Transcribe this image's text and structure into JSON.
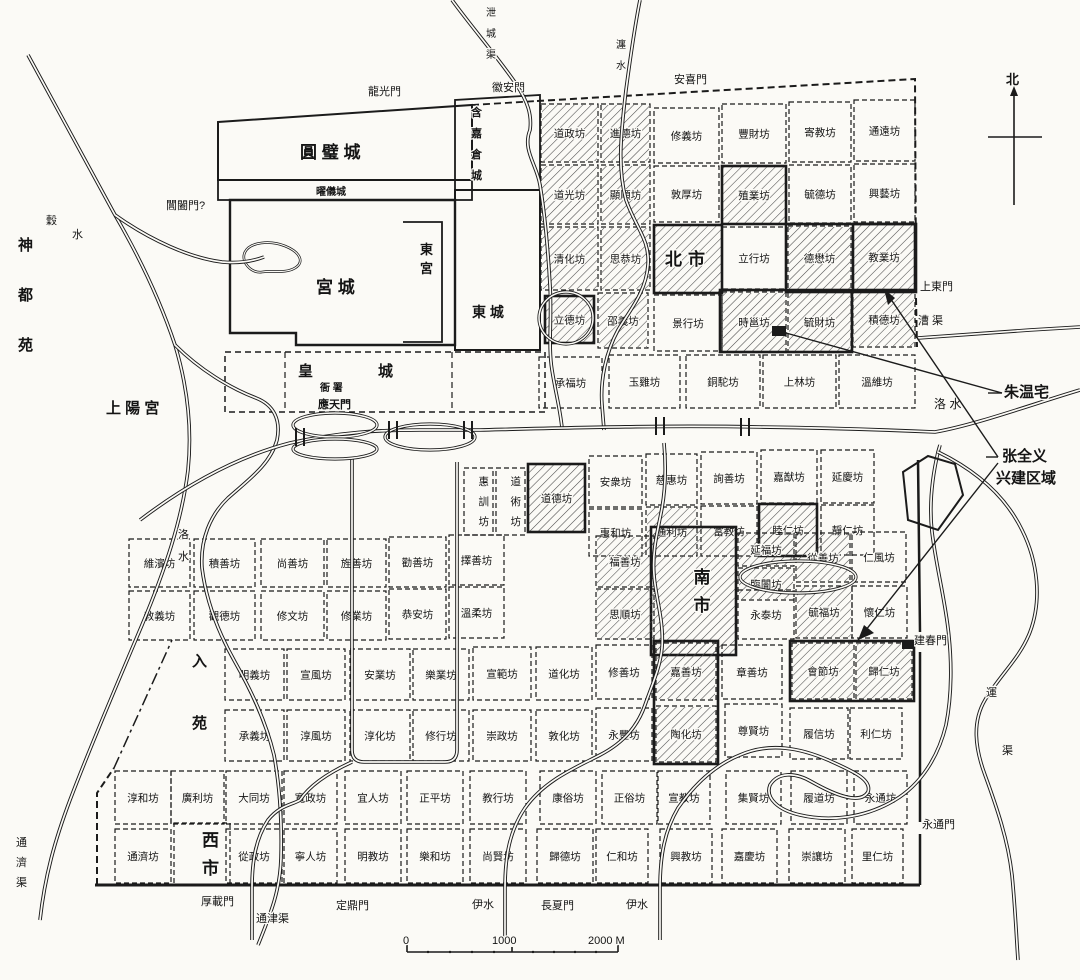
{
  "map": {
    "compass": {
      "label": "北"
    },
    "scale_bar": {
      "labels": [
        {
          "t": "0",
          "x": 403
        },
        {
          "t": "1000",
          "x": 492
        },
        {
          "t": "2000 M",
          "x": 588
        }
      ],
      "label_y": 944,
      "x1": 407,
      "x2": 618,
      "y": 952
    },
    "wards": [
      [
        "道政坊",
        541,
        104,
        57,
        58,
        "h"
      ],
      [
        "進德坊",
        601,
        104,
        49,
        58,
        "h"
      ],
      [
        "修義坊",
        654,
        108,
        65,
        55,
        ""
      ],
      [
        "豐財坊",
        722,
        104,
        64,
        59,
        ""
      ],
      [
        "寄教坊",
        789,
        102,
        62,
        60,
        ""
      ],
      [
        "通遠坊",
        854,
        100,
        61,
        61,
        ""
      ],
      [
        "道光坊",
        541,
        165,
        57,
        59,
        "h"
      ],
      [
        "顯順坊",
        601,
        165,
        49,
        59,
        "h"
      ],
      [
        "敦厚坊",
        654,
        166,
        65,
        56,
        ""
      ],
      [
        "殖業坊",
        722,
        166,
        64,
        58,
        "hb"
      ],
      [
        "毓德坊",
        789,
        165,
        62,
        58,
        ""
      ],
      [
        "興藝坊",
        854,
        164,
        61,
        58,
        ""
      ],
      [
        "清化坊",
        541,
        227,
        57,
        63,
        "h"
      ],
      [
        "思恭坊",
        601,
        227,
        49,
        63,
        "h"
      ],
      [
        "北市",
        654,
        225,
        68,
        68,
        "hbm"
      ],
      [
        "立行坊",
        722,
        227,
        64,
        62,
        ""
      ],
      [
        "德懋坊",
        788,
        226,
        63,
        64,
        "h"
      ],
      [
        "教業坊",
        853,
        224,
        62,
        66,
        "hb"
      ],
      [
        "立德坊",
        545,
        296,
        49,
        47,
        "hb"
      ],
      [
        "邵義坊",
        598,
        293,
        50,
        55,
        "h"
      ],
      [
        "景行坊",
        654,
        295,
        68,
        56,
        ""
      ],
      [
        "時邕坊",
        722,
        292,
        64,
        60,
        "h"
      ],
      [
        "毓財坊",
        788,
        292,
        63,
        60,
        "h"
      ],
      [
        "積德坊",
        853,
        292,
        62,
        55,
        "h"
      ],
      [
        "承福坊",
        539,
        357,
        63,
        51,
        ""
      ],
      [
        "玉雞坊",
        609,
        355,
        71,
        53,
        ""
      ],
      [
        "銅駝坊",
        686,
        355,
        74,
        53,
        ""
      ],
      [
        "上林坊",
        763,
        355,
        73,
        53,
        ""
      ],
      [
        "溫維坊",
        839,
        355,
        76,
        53,
        ""
      ],
      [
        "惠訓坊",
        464,
        468,
        29,
        67,
        "v"
      ],
      [
        "道術坊",
        496,
        468,
        29,
        67,
        "v"
      ],
      [
        "道德坊",
        528,
        464,
        57,
        68,
        "hb"
      ],
      [
        "安衆坊",
        589,
        456,
        53,
        51,
        ""
      ],
      [
        "慈惠坊",
        646,
        454,
        51,
        51,
        ""
      ],
      [
        "詢善坊",
        701,
        452,
        56,
        52,
        ""
      ],
      [
        "嘉猷坊",
        761,
        450,
        56,
        53,
        ""
      ],
      [
        "延慶坊",
        821,
        450,
        53,
        53,
        ""
      ],
      [
        "惠和坊",
        589,
        509,
        53,
        47,
        ""
      ],
      [
        "通利坊",
        646,
        507,
        51,
        49,
        "h"
      ],
      [
        "富教坊",
        701,
        506,
        56,
        50,
        ""
      ],
      [
        "睦仁坊",
        759,
        504,
        58,
        52,
        "hb"
      ],
      [
        "靜仁坊",
        821,
        505,
        53,
        50,
        ""
      ],
      [
        "維濱坊",
        129,
        539,
        61,
        48,
        ""
      ],
      [
        "積善坊",
        194,
        539,
        61,
        48,
        ""
      ],
      [
        "尚善坊",
        261,
        539,
        63,
        48,
        ""
      ],
      [
        "旌善坊",
        327,
        539,
        59,
        48,
        ""
      ],
      [
        "勸善坊",
        389,
        537,
        57,
        50,
        ""
      ],
      [
        "擇善坊",
        449,
        535,
        55,
        50,
        ""
      ],
      [
        "福善坊",
        596,
        536,
        58,
        51,
        "h"
      ],
      [
        "南市",
        651,
        527,
        85,
        128,
        "hbvm"
      ],
      [
        "延福坊",
        738,
        533,
        56,
        33,
        "h"
      ],
      [
        "臨闠坊",
        738,
        568,
        56,
        32,
        "h"
      ],
      [
        "從善坊",
        796,
        533,
        54,
        49,
        "h"
      ],
      [
        "仁風坊",
        852,
        532,
        54,
        50,
        ""
      ],
      [
        "教義坊",
        129,
        591,
        61,
        49,
        ""
      ],
      [
        "觀德坊",
        194,
        591,
        61,
        49,
        ""
      ],
      [
        "修文坊",
        261,
        591,
        63,
        49,
        ""
      ],
      [
        "修業坊",
        327,
        591,
        59,
        49,
        ""
      ],
      [
        "恭安坊",
        389,
        589,
        57,
        50,
        ""
      ],
      [
        "溫柔坊",
        449,
        587,
        55,
        51,
        ""
      ],
      [
        "思順坊",
        596,
        589,
        58,
        50,
        "h"
      ],
      [
        "永泰坊",
        738,
        590,
        56,
        49,
        ""
      ],
      [
        "毓福坊",
        796,
        586,
        56,
        52,
        "h"
      ],
      [
        "懷仁坊",
        852,
        586,
        55,
        52,
        ""
      ],
      [
        "明義坊",
        225,
        649,
        59,
        51,
        ""
      ],
      [
        "宣風坊",
        287,
        649,
        58,
        51,
        ""
      ],
      [
        "安業坊",
        350,
        649,
        60,
        51,
        ""
      ],
      [
        "樂業坊",
        413,
        649,
        56,
        51,
        ""
      ],
      [
        "宣範坊",
        473,
        647,
        58,
        53,
        ""
      ],
      [
        "道化坊",
        536,
        647,
        56,
        53,
        ""
      ],
      [
        "修善坊",
        596,
        645,
        56,
        54,
        ""
      ],
      [
        "嘉善坊",
        656,
        643,
        60,
        57,
        "h"
      ],
      [
        "章善坊",
        722,
        645,
        60,
        54,
        ""
      ],
      [
        "會節坊",
        792,
        643,
        62,
        56,
        "h"
      ],
      [
        "歸仁坊",
        856,
        643,
        56,
        56,
        "h"
      ],
      [
        "承義坊",
        225,
        710,
        59,
        51,
        ""
      ],
      [
        "淳風坊",
        287,
        710,
        58,
        51,
        ""
      ],
      [
        "淳化坊",
        350,
        710,
        60,
        51,
        ""
      ],
      [
        "修行坊",
        413,
        710,
        56,
        51,
        ""
      ],
      [
        "崇政坊",
        473,
        710,
        58,
        51,
        ""
      ],
      [
        "敦化坊",
        536,
        710,
        56,
        51,
        ""
      ],
      [
        "永豐坊",
        596,
        708,
        56,
        53,
        ""
      ],
      [
        "陶化坊",
        656,
        706,
        60,
        56,
        "h"
      ],
      [
        "尊賢坊",
        725,
        704,
        57,
        53,
        ""
      ],
      [
        "履信坊",
        790,
        708,
        58,
        51,
        ""
      ],
      [
        "利仁坊",
        850,
        708,
        52,
        51,
        ""
      ],
      [
        "淳和坊",
        115,
        771,
        56,
        53,
        ""
      ],
      [
        "廣利坊",
        171,
        771,
        53,
        53,
        ""
      ],
      [
        "大同坊",
        226,
        771,
        56,
        53,
        ""
      ],
      [
        "寬政坊",
        284,
        771,
        53,
        53,
        ""
      ],
      [
        "宜人坊",
        345,
        771,
        56,
        53,
        ""
      ],
      [
        "正平坊",
        407,
        771,
        56,
        53,
        ""
      ],
      [
        "教行坊",
        470,
        771,
        56,
        53,
        ""
      ],
      [
        "康俗坊",
        540,
        771,
        56,
        53,
        ""
      ],
      [
        "正俗坊",
        602,
        771,
        55,
        53,
        ""
      ],
      [
        "宣教坊",
        658,
        771,
        52,
        53,
        ""
      ],
      [
        "集賢坊",
        726,
        771,
        55,
        53,
        ""
      ],
      [
        "履道坊",
        791,
        771,
        56,
        53,
        ""
      ],
      [
        "永通坊",
        854,
        771,
        53,
        53,
        ""
      ],
      [
        "通濟坊",
        115,
        829,
        56,
        54,
        ""
      ],
      [
        "西市",
        174,
        823,
        56,
        62,
        "vm"
      ],
      [
        "從政坊",
        226,
        829,
        56,
        54,
        ""
      ],
      [
        "寧人坊",
        284,
        829,
        53,
        54,
        ""
      ],
      [
        "明教坊",
        345,
        829,
        56,
        54,
        ""
      ],
      [
        "樂和坊",
        407,
        829,
        56,
        54,
        ""
      ],
      [
        "尚賢坊",
        470,
        829,
        56,
        54,
        ""
      ],
      [
        "歸德坊",
        537,
        829,
        56,
        54,
        ""
      ],
      [
        "仁和坊",
        596,
        829,
        52,
        54,
        ""
      ],
      [
        "興教坊",
        660,
        829,
        52,
        54,
        ""
      ],
      [
        "嘉慶坊",
        722,
        829,
        55,
        54,
        ""
      ],
      [
        "崇讓坊",
        789,
        829,
        56,
        54,
        ""
      ],
      [
        "里仁坊",
        852,
        829,
        51,
        54,
        ""
      ]
    ],
    "bold_outlines": [
      [
        720,
        290,
        132,
        62
      ],
      [
        786,
        224,
        130,
        68
      ],
      [
        790,
        641,
        124,
        60
      ],
      [
        654,
        641,
        64,
        123
      ]
    ],
    "regions": [
      [
        "圓 璧 城",
        300,
        158,
        17,
        0,
        0
      ],
      [
        "曜儀城",
        316,
        195,
        10,
        0,
        0
      ],
      [
        "宮  城",
        316,
        293,
        17,
        0,
        0
      ],
      [
        "東宮",
        420,
        254,
        13,
        1,
        19
      ],
      [
        "東 城",
        472,
        317,
        14,
        0,
        0
      ],
      [
        "含嘉倉城",
        471,
        116,
        11,
        1,
        21
      ],
      [
        "皇",
        298,
        376,
        15,
        0,
        0
      ],
      [
        "城",
        378,
        376,
        15,
        0,
        0
      ],
      [
        "衙 署",
        320,
        391,
        10,
        0,
        0
      ],
      [
        "應天門",
        318,
        408,
        11,
        0,
        0
      ],
      [
        "神都苑",
        18,
        250,
        15,
        1,
        50
      ],
      [
        "上 陽 宮",
        106,
        413,
        15,
        0,
        0
      ],
      [
        "入苑",
        192,
        666,
        15,
        1,
        62
      ]
    ],
    "gates": [
      [
        "龍光門",
        368,
        95,
        11,
        0,
        0
      ],
      [
        "徽安門",
        492,
        91,
        11,
        0,
        0
      ],
      [
        "安喜門",
        674,
        83,
        11,
        0,
        0
      ],
      [
        "閶闔門?",
        166,
        209,
        11,
        0,
        0
      ],
      [
        "上東門",
        920,
        290,
        11,
        0,
        0
      ],
      [
        "建春門",
        914,
        644,
        11,
        0,
        0
      ],
      [
        "永通門",
        922,
        828,
        11,
        0,
        0
      ],
      [
        "厚載門",
        201,
        905,
        11,
        0,
        0
      ],
      [
        "定鼎門",
        336,
        909,
        11,
        0,
        0
      ],
      [
        "長夏門",
        541,
        909,
        11,
        0,
        0
      ]
    ],
    "waters": [
      [
        "泄城渠",
        486,
        16,
        10,
        1,
        21
      ],
      [
        "瀍水",
        616,
        48,
        10,
        1,
        21
      ],
      [
        "穀",
        46,
        224,
        11,
        0,
        0
      ],
      [
        "水",
        72,
        238,
        11,
        0,
        0
      ],
      [
        "洛水",
        178,
        538,
        11,
        1,
        22
      ],
      [
        "洛  水",
        934,
        408,
        12,
        0,
        0
      ],
      [
        "漕 渠",
        918,
        324,
        11,
        0,
        0
      ],
      [
        "運",
        986,
        696,
        11,
        0,
        0
      ],
      [
        "渠",
        1002,
        754,
        11,
        0,
        0
      ],
      [
        "通濟渠",
        16,
        846,
        11,
        1,
        20
      ],
      [
        "通津渠",
        256,
        922,
        11,
        0,
        0
      ],
      [
        "伊水",
        472,
        908,
        11,
        0,
        0
      ],
      [
        "伊水",
        626,
        908,
        11,
        0,
        0
      ]
    ],
    "annotations": {
      "labels": [
        [
          "朱温宅",
          1004,
          397,
          15
        ],
        [
          "张全义",
          1002,
          461,
          15
        ],
        [
          "兴建区域",
          996,
          483,
          15
        ]
      ],
      "lines": [
        [
          988,
          393,
          1002,
          393
        ],
        [
          1002,
          393,
          786,
          333
        ],
        [
          986,
          457,
          998,
          457
        ],
        [
          998,
          457,
          884,
          289
        ],
        [
          998,
          463,
          858,
          640
        ]
      ],
      "arrowheads": [
        "884,289 895,298 888,305",
        "858,640 864,625 874,633"
      ],
      "site_squares": [
        [
          772,
          326,
          14,
          10
        ],
        [
          902,
          640,
          12,
          9
        ]
      ]
    }
  }
}
